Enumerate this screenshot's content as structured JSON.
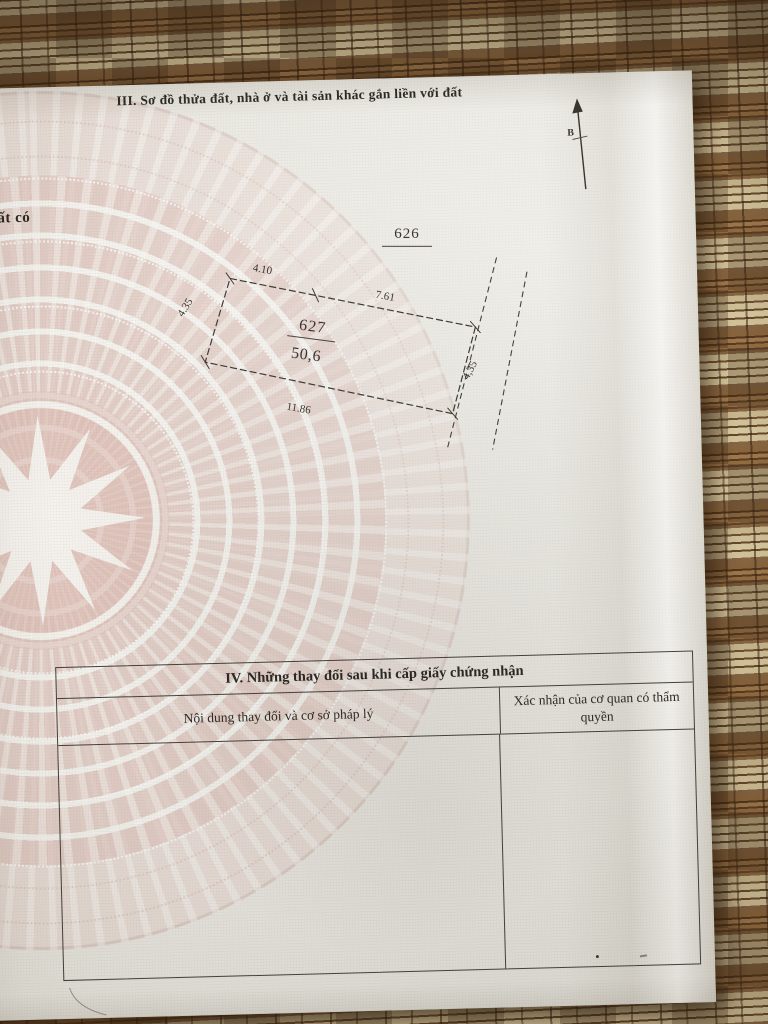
{
  "document": {
    "section_iii": {
      "title": "III. Sơ đồ thửa đất, nhà ở và tài sản khác gắn liền với đất"
    },
    "left_edge_fragment": "ất có",
    "diagram": {
      "north_label": "B",
      "adjacent_plot_number": "626",
      "plot_number": "627",
      "plot_area": "50,6",
      "dimensions": {
        "top_left": "4.10",
        "top_right": "7.61",
        "left": "4.35",
        "right": "4,35",
        "bottom": "11.86"
      }
    },
    "section_iv": {
      "title": "IV. Những thay đổi sau khi cấp giấy chứng nhận",
      "columns": [
        "Nội dung thay đổi và cơ sở pháp lý",
        "Xác nhận của cơ quan có thẩm quyền"
      ]
    }
  },
  "colors": {
    "paper": "#e9e7e0",
    "watermark_pink": "#dbb1a8",
    "ink": "#2e2a24",
    "mat_brown": "#8a6946",
    "mat_cream": "#ddd0a4"
  }
}
